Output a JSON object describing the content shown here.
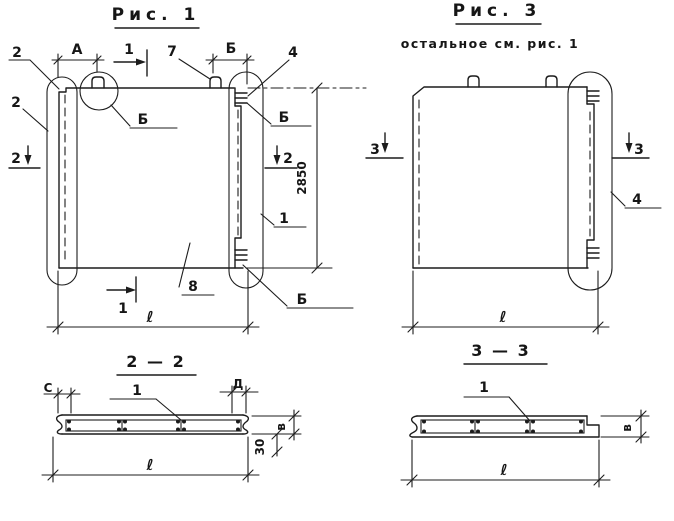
{
  "colors": {
    "ink": "#1c1c1c",
    "paper": "#ffffff"
  },
  "fig1": {
    "title": "Рис. 1",
    "marks": {
      "pos2_top": "2",
      "pos2_side": "2",
      "dimA": "А",
      "sec1_top": "1",
      "pos7": "7",
      "dimB": "Б",
      "pos4": "4",
      "detB_circle": "Б",
      "detB_top": "Б",
      "detB_bottom": "Б",
      "sec2_left": "2",
      "sec2_right": "2",
      "pos1": "1",
      "pos8": "8",
      "sec1_bottom": "1",
      "dim_height": "2850",
      "dim_length": "ℓ"
    }
  },
  "fig3": {
    "title": "Рис. 3",
    "subtitle": "остальное см. рис. 1",
    "marks": {
      "sec3_left": "3",
      "sec3_right": "3",
      "pos4": "4",
      "dim_length": "ℓ"
    }
  },
  "sec22": {
    "title": "2 — 2",
    "marks": {
      "dimC": "С",
      "dimD": "Д",
      "pos1": "1",
      "dim_b": "в",
      "dim_30": "30",
      "dim_length": "ℓ"
    }
  },
  "sec33": {
    "title": "3 — 3",
    "marks": {
      "pos1": "1",
      "dim_b": "в",
      "dim_length": "ℓ"
    }
  }
}
